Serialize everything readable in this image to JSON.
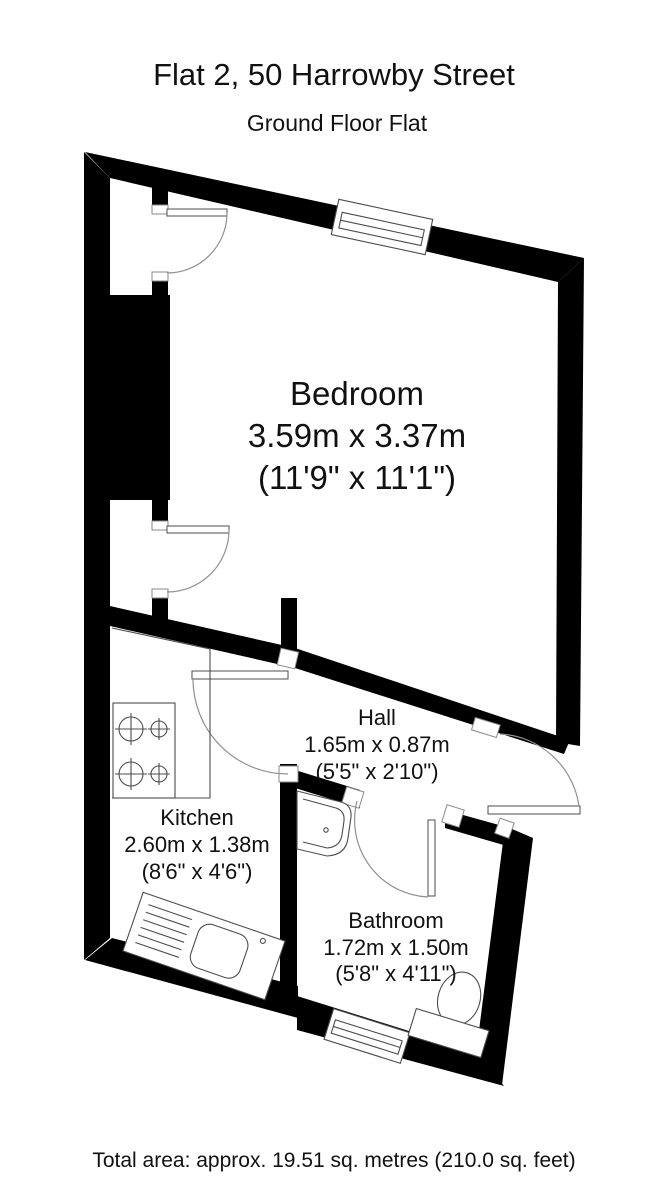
{
  "header": {
    "title": "Flat 2, 50 Harrowby Street",
    "subtitle": "Ground Floor Flat"
  },
  "rooms": [
    {
      "id": "bedroom",
      "name": "Bedroom",
      "metric": "3.59m x 3.37m",
      "imperial": "(11'9\" x 11'1\")"
    },
    {
      "id": "hall",
      "name": "Hall",
      "metric": "1.65m x 0.87m",
      "imperial": "(5'5\" x 2'10\")"
    },
    {
      "id": "kitchen",
      "name": "Kitchen",
      "metric": "2.60m x 1.38m",
      "imperial": "(8'6\" x 4'6\")"
    },
    {
      "id": "bathroom",
      "name": "Bathroom",
      "metric": "1.72m x 1.50m",
      "imperial": "(5'8\" x 4'11\")"
    }
  ],
  "footer": {
    "total_area": "Total area: approx. 19.51 sq. metres (210.0 sq. feet)"
  },
  "colors": {
    "wall": "#000000",
    "fixture_line": "#4d4d4d",
    "door_arc": "#909090",
    "background": "#ffffff"
  }
}
